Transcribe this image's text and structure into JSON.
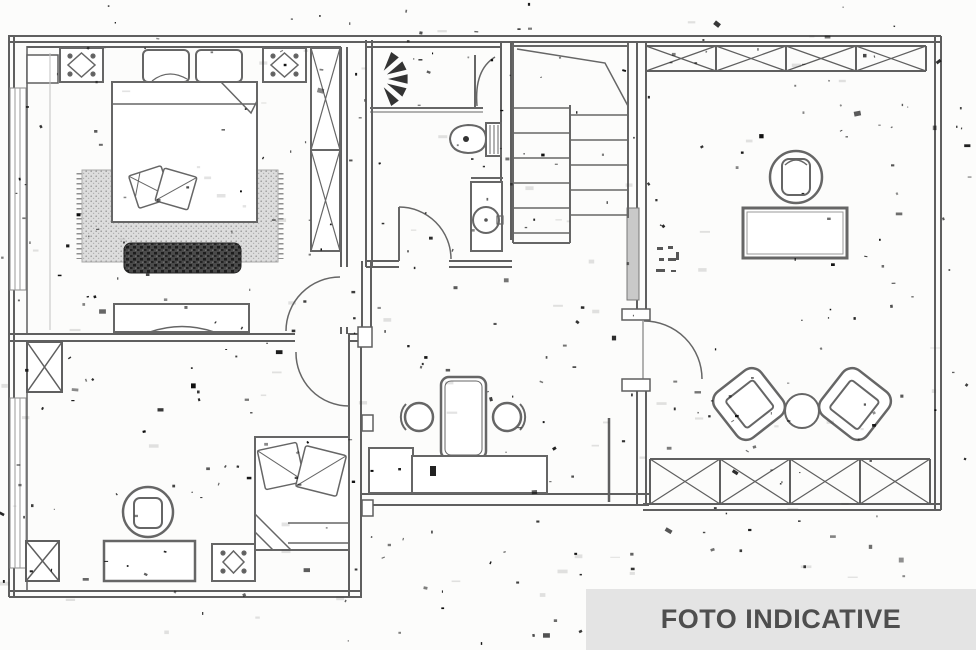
{
  "watermark": {
    "label": "FOTO INDICATIVE",
    "background": "#e4e4e4",
    "text_color": "#4e4e4e"
  },
  "plan": {
    "kind": "scanned-floor-plan",
    "wall_color": "#5f5f5f",
    "furniture_color": "#666666",
    "paper_color": "#fcfcfb",
    "hatch_fill": "#c9c9c9",
    "rug_fill": "#dddddd",
    "bench_fill": "#3f3f3f"
  }
}
